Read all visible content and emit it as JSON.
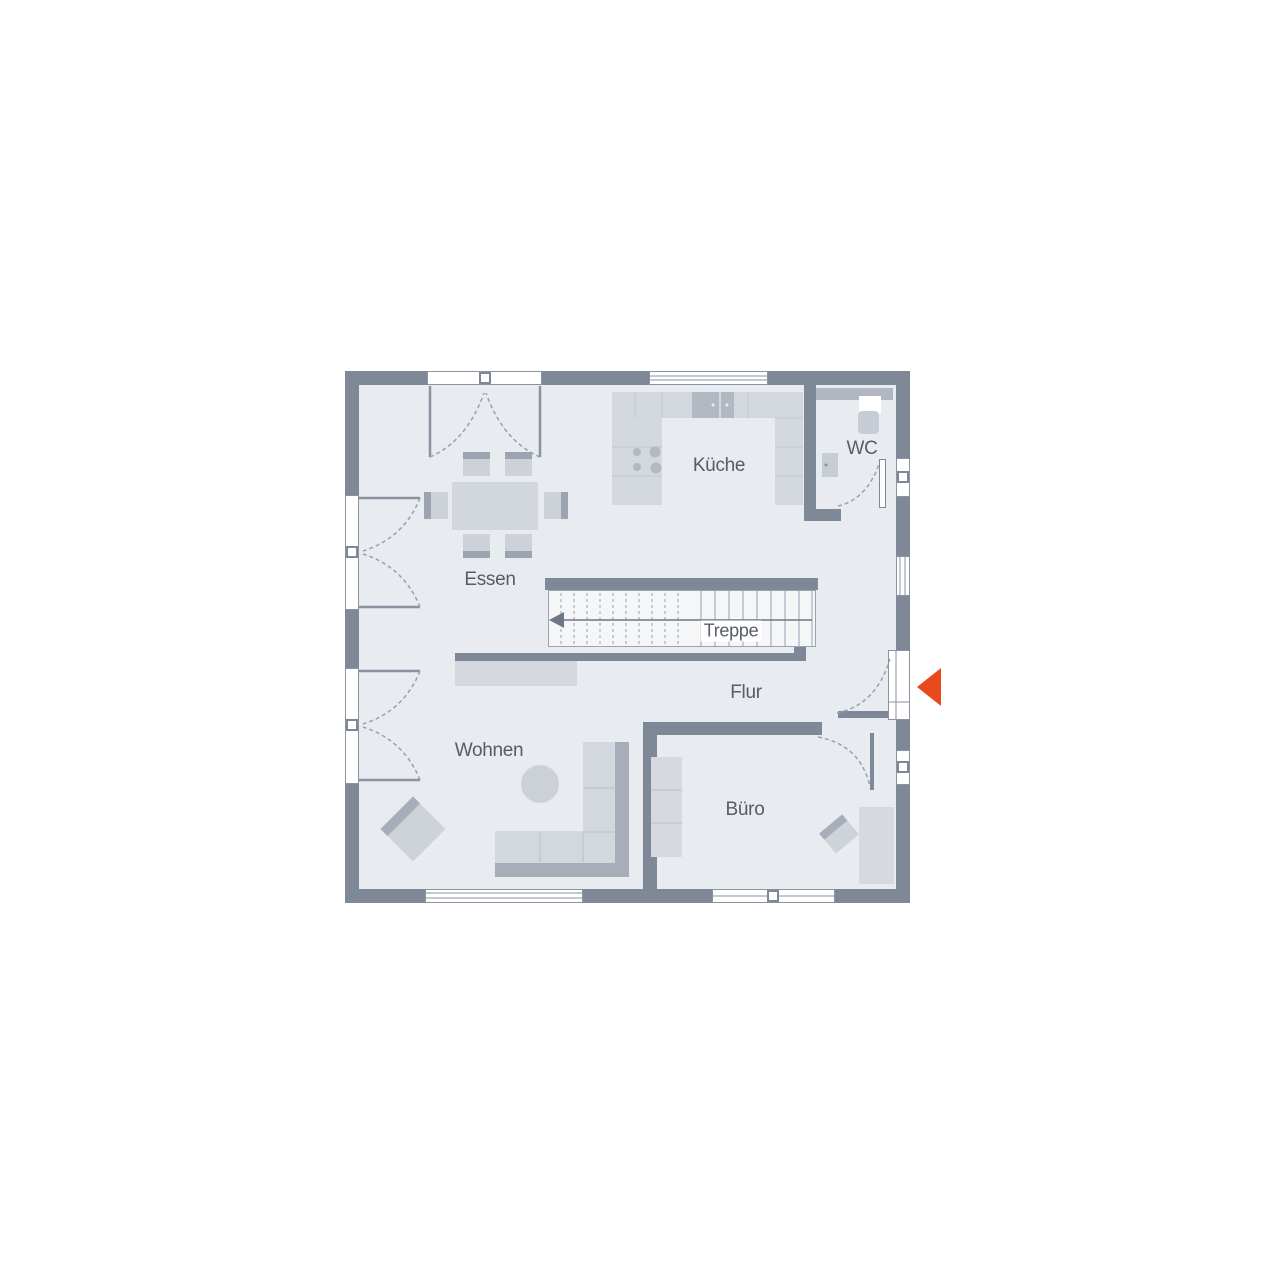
{
  "floorplan": {
    "title": "Erdgeschoss Grundriss",
    "rooms": [
      {
        "id": "kueche",
        "label": "Küche"
      },
      {
        "id": "wc",
        "label": "WC"
      },
      {
        "id": "essen",
        "label": "Essen"
      },
      {
        "id": "treppe",
        "label": "Treppe"
      },
      {
        "id": "flur",
        "label": "Flur"
      },
      {
        "id": "wohnen",
        "label": "Wohnen"
      },
      {
        "id": "buero",
        "label": "Büro"
      }
    ],
    "icons": [
      {
        "id": "entry-arrow",
        "meaning": "entrance direction arrow",
        "color": "#e8491d"
      }
    ],
    "colors": {
      "wall": "#7e8896",
      "floor": "#e8ebef",
      "furniture_light": "#d3d7de",
      "furniture_medium": "#c7ccd4",
      "furniture_dark": "#a7aeba",
      "accent": "#e8491d",
      "text": "#565d67",
      "line": "#99a1ad"
    }
  }
}
